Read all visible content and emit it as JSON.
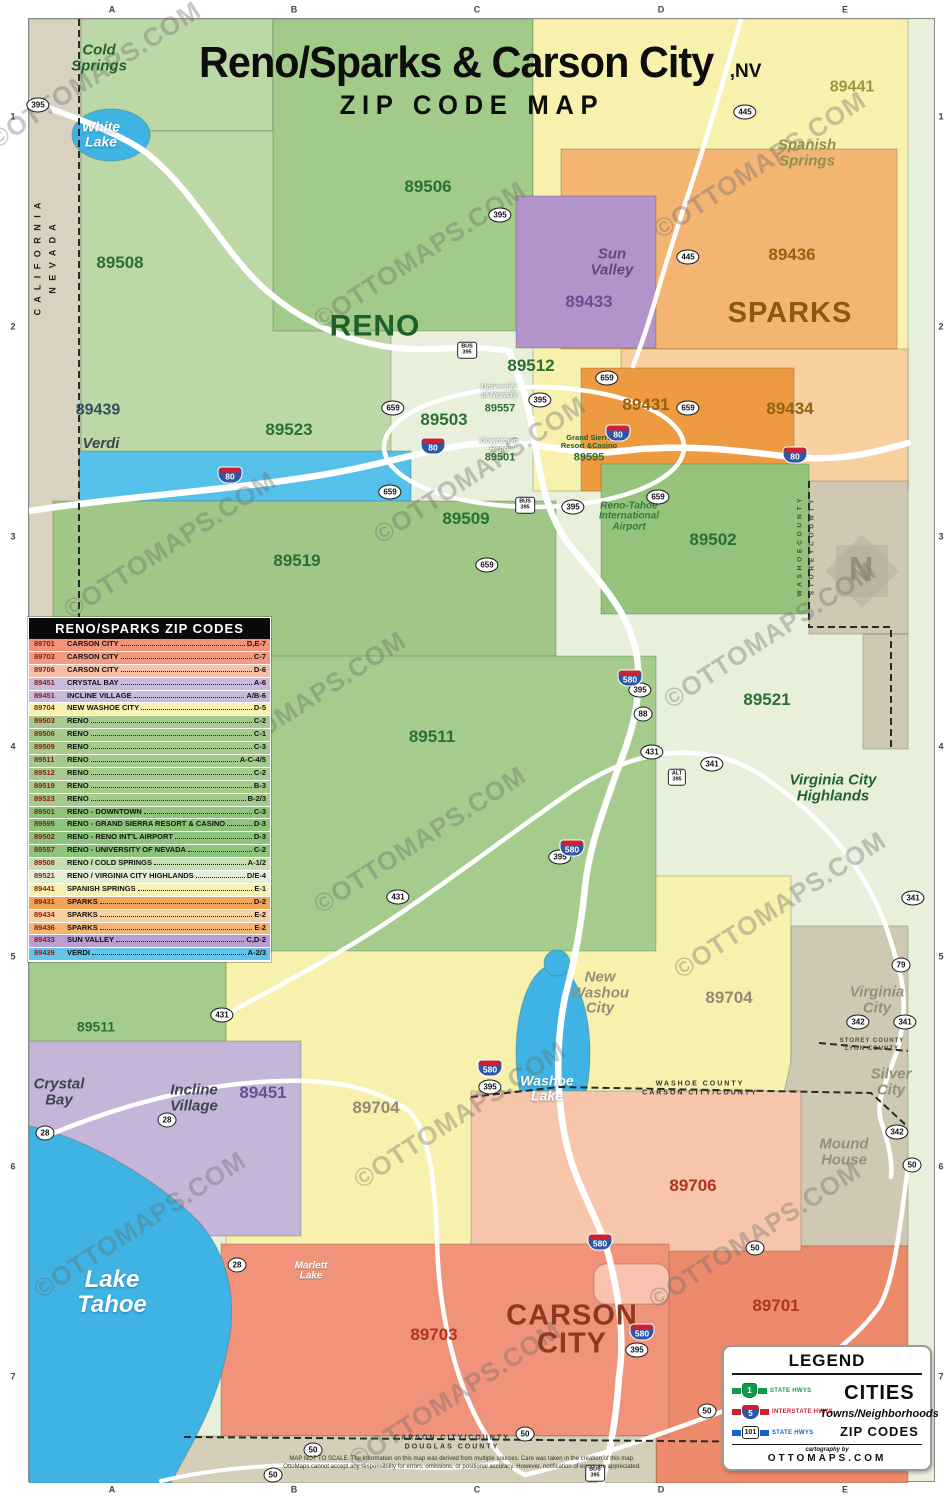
{
  "title": {
    "main": "Reno/Sparks & Carson City",
    "suffix": ",NV",
    "subtitle": "ZIP CODE MAP"
  },
  "colors": {
    "reno_green": "#a4cb8b",
    "reno_pale": "#e8f0dc",
    "sparks_orange": "#f4b573",
    "sparks_dark_orange": "#ee9a41",
    "sparks_pale_orange": "#f8cf9e",
    "spanish_springs_yellow": "#f8f1ae",
    "sun_valley_purple": "#b394ca",
    "verdi_blue": "#55c0e9",
    "incline_purple": "#c5b5d8",
    "carson_salmon": "#f0937a",
    "carson_light_salmon": "#f7c5ab",
    "county_tan": "#cfc9b4",
    "lake_blue": "#3fb4e4",
    "outside_tan": "#d9d2c0"
  },
  "zip_table": {
    "header": "RENO/SPARKS ZIP CODES",
    "rows": [
      {
        "zip": "89701",
        "name": "CARSON CITY",
        "grid": "D,E-7",
        "color": "#f2937b"
      },
      {
        "zip": "89703",
        "name": "CARSON CITY",
        "grid": "C-7",
        "color": "#f29a82"
      },
      {
        "zip": "89706",
        "name": "CARSON CITY",
        "grid": "D-6",
        "color": "#f7bfa4"
      },
      {
        "zip": "89451",
        "name": "CRYSTAL BAY",
        "grid": "A-6",
        "color": "#c9badb"
      },
      {
        "zip": "89451",
        "name": "INCLINE VILLAGE",
        "grid": "A/B-6",
        "color": "#c9badb"
      },
      {
        "zip": "89704",
        "name": "NEW WASHOE CITY",
        "grid": "D-5",
        "color": "#f8f2b2"
      },
      {
        "zip": "89503",
        "name": "RENO",
        "grid": "C-2",
        "color": "#a4cb8b"
      },
      {
        "zip": "89506",
        "name": "RENO",
        "grid": "C-1",
        "color": "#a4cb8b"
      },
      {
        "zip": "89509",
        "name": "RENO",
        "grid": "C-3",
        "color": "#a4cb8b"
      },
      {
        "zip": "89511",
        "name": "RENO",
        "grid": "A-C-4/5",
        "color": "#a4cb8b"
      },
      {
        "zip": "89512",
        "name": "RENO",
        "grid": "C-2",
        "color": "#a4cb8b"
      },
      {
        "zip": "89519",
        "name": "RENO",
        "grid": "B-3",
        "color": "#a4cb8b"
      },
      {
        "zip": "89523",
        "name": "RENO",
        "grid": "B-2/3",
        "color": "#a4cb8b"
      },
      {
        "zip": "89501",
        "name": "RENO - DOWNTOWN",
        "grid": "C-3",
        "color": "#8cc47a"
      },
      {
        "zip": "89595",
        "name": "RENO - GRAND SIERRA RESORT & CASINO",
        "grid": "D-3",
        "color": "#8cc47a"
      },
      {
        "zip": "89502",
        "name": "RENO - RENO INT'L AIRPORT",
        "grid": "D-3",
        "color": "#8cc47a"
      },
      {
        "zip": "89557",
        "name": "RENO - UNIVERSITY OF NEVADA",
        "grid": "C-2",
        "color": "#8cc47a"
      },
      {
        "zip": "89508",
        "name": "RENO / COLD SPRINGS",
        "grid": "A-1/2",
        "color": "#c6dfb2"
      },
      {
        "zip": "89521",
        "name": "RENO / VIRGINIA CITY HIGHLANDS",
        "grid": "D/E-4",
        "color": "#e3eed6"
      },
      {
        "zip": "89441",
        "name": "SPANISH SPRINGS",
        "grid": "E-1",
        "color": "#f8f2b2"
      },
      {
        "zip": "89431",
        "name": "SPARKS",
        "grid": "D-2",
        "color": "#f2a459"
      },
      {
        "zip": "89434",
        "name": "SPARKS",
        "grid": "E-2",
        "color": "#f8cf9e"
      },
      {
        "zip": "89436",
        "name": "SPARKS",
        "grid": "E-2",
        "color": "#f4b573"
      },
      {
        "zip": "89433",
        "name": "SUN VALLEY",
        "grid": "C,D-2",
        "color": "#bb9dd1"
      },
      {
        "zip": "89439",
        "name": "VERDI",
        "grid": "A-2/3",
        "color": "#62c4ea"
      }
    ]
  },
  "legend": {
    "title": "LEGEND",
    "items": [
      {
        "shield": "1",
        "label": "STATE HWYS",
        "cls": "lg-state"
      },
      {
        "shield": "5",
        "label": "INTERSTATE HWYS",
        "cls": "lg-int"
      },
      {
        "shield": "101",
        "label": "STATE HWYS",
        "cls": "lg-us"
      }
    ],
    "cities": "CITIES",
    "towns": "Towns/Neighborhoods",
    "zip": "ZIP CODES",
    "credit_pre": "cartography by",
    "credit": "OTTOMAPS.COM"
  },
  "map": {
    "labels": [
      {
        "text": "RENO",
        "x": 375,
        "y": 326,
        "cls": "city city-green"
      },
      {
        "text": "SPARKS",
        "x": 790,
        "y": 313,
        "cls": "city city-brown"
      },
      {
        "text": "CARSON\nCITY",
        "x": 572,
        "y": 1330,
        "cls": "city city-red"
      },
      {
        "text": "89506",
        "x": 428,
        "y": 187,
        "cls": "zip zc-green"
      },
      {
        "text": "89508",
        "x": 120,
        "y": 263,
        "cls": "zip zc-green"
      },
      {
        "text": "89441",
        "x": 852,
        "y": 88,
        "cls": "zip zc-olive"
      },
      {
        "text": "89439",
        "x": 98,
        "y": 411,
        "cls": "zip zc-navy"
      },
      {
        "text": "89433",
        "x": 589,
        "y": 302,
        "cls": "zip zc-purple"
      },
      {
        "text": "89512",
        "x": 531,
        "y": 366,
        "cls": "zip zc-green"
      },
      {
        "text": "89436",
        "x": 792,
        "y": 255,
        "cls": "zip zc-brown"
      },
      {
        "text": "89431",
        "x": 646,
        "y": 405,
        "cls": "zip zc-brown"
      },
      {
        "text": "89434",
        "x": 790,
        "y": 409,
        "cls": "zip zc-brown"
      },
      {
        "text": "89523",
        "x": 289,
        "y": 430,
        "cls": "zip zc-green"
      },
      {
        "text": "89503",
        "x": 444,
        "y": 420,
        "cls": "zip zc-green"
      },
      {
        "text": "89557",
        "x": 500,
        "y": 409,
        "cls": "zip zc-green-sm"
      },
      {
        "text": "89501",
        "x": 500,
        "y": 458,
        "cls": "zip zc-green-sm"
      },
      {
        "text": "89595",
        "x": 589,
        "y": 458,
        "cls": "zip zc-green-sm"
      },
      {
        "text": "89509",
        "x": 466,
        "y": 519,
        "cls": "zip zc-green"
      },
      {
        "text": "89519",
        "x": 297,
        "y": 561,
        "cls": "zip zc-green"
      },
      {
        "text": "89502",
        "x": 713,
        "y": 540,
        "cls": "zip zc-green"
      },
      {
        "text": "89521",
        "x": 767,
        "y": 700,
        "cls": "zip zc-green"
      },
      {
        "text": "89511",
        "x": 432,
        "y": 737,
        "cls": "zip zc-green"
      },
      {
        "text": "89511",
        "x": 96,
        "y": 1027,
        "cls": "zip zc-green-sm2"
      },
      {
        "text": "89451",
        "x": 263,
        "y": 1093,
        "cls": "zip zc-purple"
      },
      {
        "text": "89704",
        "x": 729,
        "y": 998,
        "cls": "zip zc-gray"
      },
      {
        "text": "89704",
        "x": 376,
        "y": 1108,
        "cls": "zip zc-gray"
      },
      {
        "text": "89706",
        "x": 693,
        "y": 1186,
        "cls": "zip zc-red"
      },
      {
        "text": "89703",
        "x": 434,
        "y": 1335,
        "cls": "zip zc-red"
      },
      {
        "text": "89701",
        "x": 776,
        "y": 1306,
        "cls": "zip zc-red"
      },
      {
        "text": "Cold\nSprings",
        "x": 99,
        "y": 58,
        "cls": "town t-green"
      },
      {
        "text": "White\nLake",
        "x": 101,
        "y": 134,
        "cls": "lake-md"
      },
      {
        "text": "Spanish\nSprings",
        "x": 807,
        "y": 153,
        "cls": "town t-olive"
      },
      {
        "text": "Sun\nValley",
        "x": 612,
        "y": 262,
        "cls": "town t-purple"
      },
      {
        "text": "Verdi",
        "x": 101,
        "y": 444,
        "cls": "town t-dark"
      },
      {
        "text": "Virginia City\nHighlands",
        "x": 833,
        "y": 788,
        "cls": "town t-green"
      },
      {
        "text": "Virginia\nCity",
        "x": 877,
        "y": 1000,
        "cls": "town t-gray"
      },
      {
        "text": "Silver\nCity",
        "x": 891,
        "y": 1082,
        "cls": "town t-gray"
      },
      {
        "text": "Mound\nHouse",
        "x": 844,
        "y": 1152,
        "cls": "town t-gray"
      },
      {
        "text": "New\nWashou\nCity",
        "x": 600,
        "y": 993,
        "cls": "town t-gray"
      },
      {
        "text": "Crystal\nBay",
        "x": 59,
        "y": 1092,
        "cls": "town t-dark"
      },
      {
        "text": "Incline\nVillage",
        "x": 194,
        "y": 1098,
        "cls": "town t-dark"
      },
      {
        "text": "Lake\nTahoe",
        "x": 112,
        "y": 1293,
        "cls": "lake-lg"
      },
      {
        "text": "Washoe\nLake",
        "x": 547,
        "y": 1088,
        "cls": "lake-md"
      },
      {
        "text": "Marlett\nLake",
        "x": 311,
        "y": 1272,
        "cls": "lake-sm"
      },
      {
        "text": "Reno-Tahoe\nInternational\nAirport",
        "x": 629,
        "y": 517,
        "cls": "t-airport"
      },
      {
        "text": "University\nof Nevada",
        "x": 499,
        "y": 391,
        "cls": "tiny-white"
      },
      {
        "text": "Downtown\nReno",
        "x": 499,
        "y": 445,
        "cls": "tiny-white"
      },
      {
        "text": "Grand Sierra\nResort &Casino",
        "x": 589,
        "y": 442,
        "cls": "tiny-green"
      },
      {
        "text": "N",
        "x": 861,
        "y": 570,
        "cls": "compass-n"
      }
    ],
    "counties": [
      {
        "text": "C A L I F O R N I A",
        "x": 38,
        "y": 258,
        "cls": "county-v"
      },
      {
        "text": "N E V A D A",
        "x": 53,
        "y": 258,
        "cls": "county-v"
      },
      {
        "text": "W A S H O E   C O U N T Y",
        "x": 801,
        "y": 547,
        "cls": "county-v sm"
      },
      {
        "text": "S T O R E Y   C O U N T Y",
        "x": 813,
        "y": 547,
        "cls": "county-v sm"
      },
      {
        "text": "WASHOE COUNTY",
        "x": 700,
        "y": 1084,
        "cls": "county-h"
      },
      {
        "text": "CARSON CITY/COUNTY",
        "x": 700,
        "y": 1093,
        "cls": "county-h"
      },
      {
        "text": "STOREY COUNTY",
        "x": 872,
        "y": 1041,
        "cls": "county-h xs"
      },
      {
        "text": "LYON COUNTY",
        "x": 872,
        "y": 1049,
        "cls": "county-h xs"
      },
      {
        "text": "CARSON CITY/COUNTY",
        "x": 452,
        "y": 1438,
        "cls": "county-h"
      },
      {
        "text": "DOUGLAS COUNTY",
        "x": 452,
        "y": 1447,
        "cls": "county-h"
      }
    ],
    "disclaimer": {
      "line1": "MAP NOT TO SCALE. The information on this map was derived from multiple sources. Care was taken in the creation of this map.",
      "line2": "OttoMaps cannot accept any responsibility for errors, omissions, or positional accuracy. However, notification of errors are appreciated."
    },
    "shields": [
      {
        "text": "395",
        "x": 38,
        "y": 105,
        "cls": "sh-oval"
      },
      {
        "text": "395",
        "x": 500,
        "y": 215,
        "cls": "sh-oval"
      },
      {
        "text": "395",
        "x": 540,
        "y": 400,
        "cls": "sh-oval"
      },
      {
        "text": "395",
        "x": 573,
        "y": 507,
        "cls": "sh-oval"
      },
      {
        "text": "395",
        "x": 640,
        "y": 690,
        "cls": "sh-oval"
      },
      {
        "text": "395",
        "x": 560,
        "y": 857,
        "cls": "sh-oval"
      },
      {
        "text": "395",
        "x": 490,
        "y": 1087,
        "cls": "sh-oval"
      },
      {
        "text": "395",
        "x": 637,
        "y": 1350,
        "cls": "sh-oval"
      },
      {
        "text": "445",
        "x": 745,
        "y": 112,
        "cls": "sh-oval"
      },
      {
        "text": "445",
        "x": 688,
        "y": 257,
        "cls": "sh-oval"
      },
      {
        "text": "659",
        "x": 393,
        "y": 408,
        "cls": "sh-oval"
      },
      {
        "text": "659",
        "x": 607,
        "y": 378,
        "cls": "sh-oval"
      },
      {
        "text": "659",
        "x": 688,
        "y": 408,
        "cls": "sh-oval"
      },
      {
        "text": "659",
        "x": 390,
        "y": 492,
        "cls": "sh-oval"
      },
      {
        "text": "659",
        "x": 658,
        "y": 497,
        "cls": "sh-oval"
      },
      {
        "text": "659",
        "x": 487,
        "y": 565,
        "cls": "sh-oval"
      },
      {
        "text": "431",
        "x": 652,
        "y": 752,
        "cls": "sh-oval"
      },
      {
        "text": "431",
        "x": 398,
        "y": 897,
        "cls": "sh-oval"
      },
      {
        "text": "431",
        "x": 222,
        "y": 1015,
        "cls": "sh-oval"
      },
      {
        "text": "341",
        "x": 712,
        "y": 764,
        "cls": "sh-oval"
      },
      {
        "text": "341",
        "x": 913,
        "y": 898,
        "cls": "sh-oval"
      },
      {
        "text": "341",
        "x": 905,
        "y": 1022,
        "cls": "sh-oval"
      },
      {
        "text": "342",
        "x": 858,
        "y": 1022,
        "cls": "sh-oval"
      },
      {
        "text": "342",
        "x": 897,
        "y": 1132,
        "cls": "sh-oval"
      },
      {
        "text": "79",
        "x": 901,
        "y": 965,
        "cls": "sh-oval"
      },
      {
        "text": "88",
        "x": 643,
        "y": 714,
        "cls": "sh-oval"
      },
      {
        "text": "28",
        "x": 45,
        "y": 1133,
        "cls": "sh-oval"
      },
      {
        "text": "28",
        "x": 167,
        "y": 1120,
        "cls": "sh-oval"
      },
      {
        "text": "28",
        "x": 237,
        "y": 1265,
        "cls": "sh-oval"
      },
      {
        "text": "50",
        "x": 912,
        "y": 1165,
        "cls": "sh-oval"
      },
      {
        "text": "50",
        "x": 755,
        "y": 1248,
        "cls": "sh-oval"
      },
      {
        "text": "50",
        "x": 707,
        "y": 1411,
        "cls": "sh-oval"
      },
      {
        "text": "50",
        "x": 525,
        "y": 1434,
        "cls": "sh-oval"
      },
      {
        "text": "50",
        "x": 313,
        "y": 1450,
        "cls": "sh-oval"
      },
      {
        "text": "50",
        "x": 273,
        "y": 1475,
        "cls": "sh-oval"
      },
      {
        "text": "80",
        "x": 230,
        "y": 475,
        "cls": "sh-i"
      },
      {
        "text": "80",
        "x": 433,
        "y": 446,
        "cls": "sh-i"
      },
      {
        "text": "80",
        "x": 618,
        "y": 433,
        "cls": "sh-i"
      },
      {
        "text": "80",
        "x": 795,
        "y": 455,
        "cls": "sh-i"
      },
      {
        "text": "580",
        "x": 630,
        "y": 678,
        "cls": "sh-i"
      },
      {
        "text": "580",
        "x": 572,
        "y": 848,
        "cls": "sh-i"
      },
      {
        "text": "580",
        "x": 490,
        "y": 1068,
        "cls": "sh-i"
      },
      {
        "text": "580",
        "x": 600,
        "y": 1242,
        "cls": "sh-i"
      },
      {
        "text": "580",
        "x": 642,
        "y": 1332,
        "cls": "sh-i"
      },
      {
        "text": "BUS\n395",
        "x": 467,
        "y": 350,
        "cls": "sh-bus"
      },
      {
        "text": "BUS\n395",
        "x": 525,
        "y": 505,
        "cls": "sh-bus"
      },
      {
        "text": "BUS\n395",
        "x": 595,
        "y": 1473,
        "cls": "sh-bus"
      },
      {
        "text": "ALT\n395",
        "x": 677,
        "y": 777,
        "cls": "sh-bus"
      }
    ],
    "watermarks": [
      {
        "text": "©OTTOMAPS.COM",
        "x": 95,
        "y": 75
      },
      {
        "text": "©OTTOMAPS.COM",
        "x": 420,
        "y": 255
      },
      {
        "text": "©OTTOMAPS.COM",
        "x": 760,
        "y": 165
      },
      {
        "text": "©OTTOMAPS.COM",
        "x": 170,
        "y": 545
      },
      {
        "text": "©OTTOMAPS.COM",
        "x": 480,
        "y": 470
      },
      {
        "text": "©OTTOMAPS.COM",
        "x": 770,
        "y": 635
      },
      {
        "text": "©OTTOMAPS.COM",
        "x": 420,
        "y": 840
      },
      {
        "text": "©OTTOMAPS.COM",
        "x": 780,
        "y": 905
      },
      {
        "text": "©OTTOMAPS.COM",
        "x": 140,
        "y": 1225
      },
      {
        "text": "©OTTOMAPS.COM",
        "x": 460,
        "y": 1115
      },
      {
        "text": "©OTTOMAPS.COM",
        "x": 755,
        "y": 1235
      },
      {
        "text": "©OTTOMAPS.COM",
        "x": 455,
        "y": 1395
      },
      {
        "text": "©OTTOMAPS.COM",
        "x": 300,
        "y": 705
      }
    ],
    "grid_top": [
      {
        "text": "A",
        "x": 112,
        "y": 10
      },
      {
        "text": "B",
        "x": 294,
        "y": 10
      },
      {
        "text": "C",
        "x": 477,
        "y": 10
      },
      {
        "text": "D",
        "x": 661,
        "y": 10
      },
      {
        "text": "E",
        "x": 845,
        "y": 10
      }
    ],
    "grid_bottom": [
      {
        "text": "A",
        "x": 112,
        "y": 1490
      },
      {
        "text": "B",
        "x": 294,
        "y": 1490
      },
      {
        "text": "C",
        "x": 477,
        "y": 1490
      },
      {
        "text": "D",
        "x": 661,
        "y": 1490
      },
      {
        "text": "E",
        "x": 845,
        "y": 1490
      }
    ],
    "grid_left": [
      {
        "text": "1",
        "x": 13,
        "y": 117
      },
      {
        "text": "2",
        "x": 13,
        "y": 327
      },
      {
        "text": "3",
        "x": 13,
        "y": 537
      },
      {
        "text": "4",
        "x": 13,
        "y": 747
      },
      {
        "text": "5",
        "x": 13,
        "y": 957
      },
      {
        "text": "6",
        "x": 13,
        "y": 1167
      },
      {
        "text": "7",
        "x": 13,
        "y": 1377
      }
    ],
    "grid_right": [
      {
        "text": "1",
        "x": 941,
        "y": 117
      },
      {
        "text": "2",
        "x": 941,
        "y": 327
      },
      {
        "text": "3",
        "x": 941,
        "y": 537
      },
      {
        "text": "4",
        "x": 941,
        "y": 747
      },
      {
        "text": "5",
        "x": 941,
        "y": 957
      },
      {
        "text": "6",
        "x": 941,
        "y": 1167
      },
      {
        "text": "7",
        "x": 941,
        "y": 1377
      }
    ]
  }
}
